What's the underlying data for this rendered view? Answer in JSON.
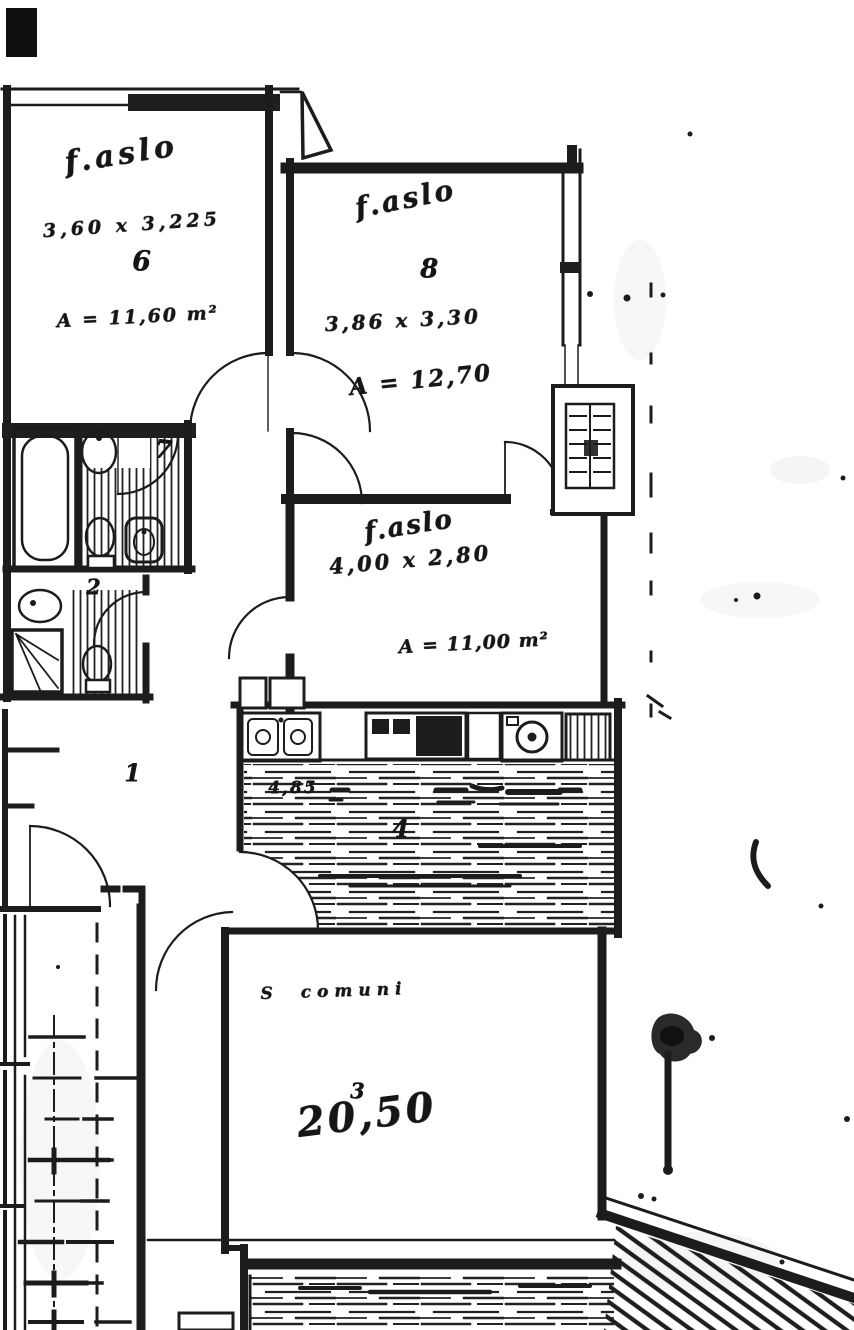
{
  "document_kind": "scanned floor plan",
  "ink": "#1c1c1c",
  "paper": "#ffffff",
  "rooms": {
    "room6": {
      "label": "f.aslo",
      "dims": "3,60 x 3,225",
      "number": "6",
      "area": "A = 11,60 m²"
    },
    "room8": {
      "label": "f.aslo",
      "number": "8",
      "dims": "3,86 x 3,30",
      "area": "A = 12,70"
    },
    "room_mid": {
      "label": "f.aslo",
      "dims": "4,00 x 2,80",
      "area": "A = 11,00 m²"
    },
    "kitchen": {
      "number": "4",
      "note": "4,85"
    },
    "living": {
      "label": "S comuni",
      "number": "3",
      "area": "20,50"
    },
    "bath_main": {
      "number": "7"
    },
    "bath_small": {
      "number": "2"
    },
    "hall": {
      "number": "1"
    }
  },
  "symbols": [
    "bathtub-icon",
    "washbasin-icon",
    "toilet-icon",
    "bidet-icon",
    "shower-icon",
    "kitchen-sink-icon",
    "stove-icon",
    "washing-machine-icon",
    "fridge-icon",
    "radiator-icon",
    "door-swing",
    "stairs",
    "terrace-hatch"
  ]
}
